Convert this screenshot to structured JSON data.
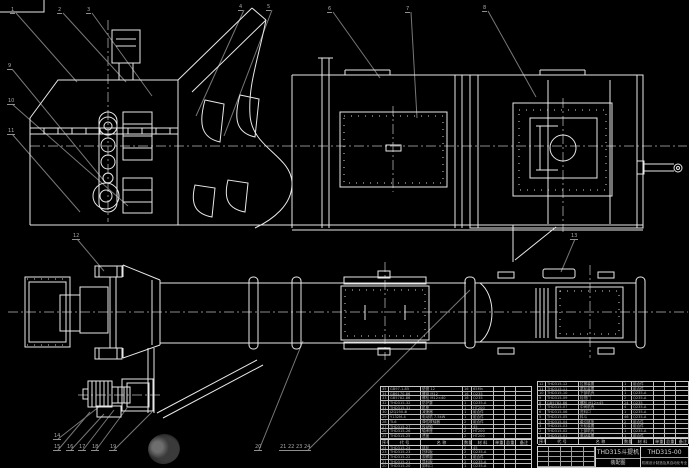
{
  "drawing": {
    "number": "THD315-00",
    "title": "THD315斗提机",
    "subtitle": "装配图",
    "org": "机械设计制造及其自动化专业"
  },
  "colors": {
    "background": "#000000",
    "line": "#e8e8e8",
    "centerline": "#8a8a8a",
    "leader": "#777777",
    "callout": "#a8a8a8",
    "table_line": "#c9c9c9",
    "table_text": "#b5b5b5",
    "title_text": "#d8d8d8"
  },
  "callouts": [
    {
      "label": "1",
      "x": 10,
      "y": 8
    },
    {
      "label": "2",
      "x": 57,
      "y": 8
    },
    {
      "label": "3",
      "x": 86,
      "y": 8
    },
    {
      "label": "4",
      "x": 238,
      "y": 5
    },
    {
      "label": "5",
      "x": 266,
      "y": 5
    },
    {
      "label": "6",
      "x": 327,
      "y": 7
    },
    {
      "label": "7",
      "x": 405,
      "y": 7
    },
    {
      "label": "8",
      "x": 482,
      "y": 6
    },
    {
      "label": "9",
      "x": 7,
      "y": 64
    },
    {
      "label": "10",
      "x": 7,
      "y": 99
    },
    {
      "label": "11",
      "x": 7,
      "y": 129
    },
    {
      "label": "12",
      "x": 72,
      "y": 234
    },
    {
      "label": "13",
      "x": 570,
      "y": 234
    },
    {
      "label": "14",
      "x": 53,
      "y": 434
    },
    {
      "label": "15",
      "x": 53,
      "y": 445
    },
    {
      "label": "16",
      "x": 66,
      "y": 445
    },
    {
      "label": "17",
      "x": 78,
      "y": 445
    },
    {
      "label": "18",
      "x": 91,
      "y": 445
    },
    {
      "label": "19",
      "x": 109,
      "y": 445
    },
    {
      "label": "20",
      "x": 254,
      "y": 445
    },
    {
      "label": "21",
      "x": 279,
      "y": 445
    },
    {
      "label": "22",
      "x": 287,
      "y": 445
    },
    {
      "label": "23",
      "x": 295,
      "y": 445
    },
    {
      "label": "24",
      "x": 303,
      "y": 445
    }
  ],
  "bom_right": {
    "headers": [
      "序号",
      "代  号",
      "名  称",
      "数量",
      "材  料",
      "单重",
      "总重",
      "备注"
    ],
    "col_widths": [
      8,
      33,
      44,
      9,
      22,
      11,
      11,
      14
    ],
    "rows": [
      [
        "12",
        "THD315-12",
        "拉紧装置",
        "1",
        "组合件",
        "",
        "",
        ""
      ],
      [
        "11",
        "THD315-11",
        "尾轮装置",
        "1",
        "组合件",
        "",
        "",
        ""
      ],
      [
        "10",
        "THD315-10",
        "下部机壳",
        "1",
        "Q235-A",
        "",
        "",
        ""
      ],
      [
        "9",
        "THD315-09",
        "检视门",
        "2",
        "Q235-A",
        "",
        "",
        ""
      ],
      [
        "8",
        "GB5782-86",
        "螺栓 M12×45",
        "24",
        "Q235",
        "",
        "",
        ""
      ],
      [
        "7",
        "THD315-07",
        "中间机壳",
        "4",
        "Q235-A",
        "",
        "",
        ""
      ],
      [
        "6",
        "THD315-06",
        "进料口",
        "1",
        "Q235-A",
        "",
        "",
        ""
      ],
      [
        "5",
        "THD315-05",
        "料斗",
        "46",
        "Q235-A",
        "",
        "",
        ""
      ],
      [
        "4",
        "THD315-04",
        "牵引链条",
        "2",
        "组合件",
        "",
        "",
        ""
      ],
      [
        "3",
        "THD315-03",
        "头轮装置",
        "1",
        "组合件",
        "",
        "",
        ""
      ],
      [
        "2",
        "THD315-02",
        "上部机壳",
        "1",
        "Q235-A",
        "",
        "",
        ""
      ],
      [
        "1",
        "THD315-01",
        "驱动装置",
        "1",
        "组合件",
        "",
        "",
        ""
      ]
    ]
  },
  "bom_left": {
    "headers": [
      "序号",
      "代  号",
      "名  称",
      "数量",
      "材  料",
      "单重",
      "总重",
      "备注"
    ],
    "col_widths": [
      8,
      32,
      42,
      9,
      22,
      11,
      11,
      16
    ],
    "upper_rows": [
      [
        "35",
        "GB97.1-85",
        "垫圈 12",
        "16",
        "65Mn",
        "",
        "",
        ""
      ],
      [
        "34",
        "GB6170-86",
        "螺母 M12",
        "16",
        "Q235",
        "",
        "",
        ""
      ],
      [
        "33",
        "GB5782-86",
        "螺栓 M12×40",
        "16",
        "Q235",
        "",
        "",
        ""
      ],
      [
        "32",
        "THD315-32",
        "防护罩",
        "1",
        "Q235-A",
        "",
        "",
        ""
      ],
      [
        "31",
        "THD315-31",
        "机座",
        "1",
        "HT200",
        "",
        "",
        ""
      ],
      [
        "30",
        "JZQ250-Ⅲ",
        "减速器",
        "1",
        "组合件",
        "",
        "",
        ""
      ],
      [
        "29",
        "Y132M-4",
        "电动机 7.5kW",
        "1",
        "组合件",
        "",
        "",
        ""
      ],
      [
        "28",
        "TL6",
        "弹性联轴器",
        "2",
        "组合件",
        "",
        "",
        ""
      ],
      [
        "27",
        "THD315-27",
        "传动轴",
        "1",
        "45",
        "",
        "",
        ""
      ],
      [
        "26",
        "THD315-26",
        "轴承座",
        "2",
        "HT200",
        "",
        "",
        ""
      ],
      [
        "25",
        "THD315-25",
        "透盖",
        "2",
        "HT200",
        "",
        "",
        ""
      ]
    ],
    "lower_rows": [
      [
        "24",
        "THD315-24",
        "链轮",
        "2",
        "45",
        "",
        "",
        ""
      ],
      [
        "23",
        "THD315-23",
        "挡料板",
        "2",
        "Q235-A",
        "",
        "",
        ""
      ],
      [
        "22",
        "THD315-22",
        "观察窗",
        "1",
        "组合件",
        "",
        "",
        ""
      ],
      [
        "21",
        "THD315-21",
        "导料板",
        "2",
        "Q235-A",
        "",
        "",
        ""
      ],
      [
        "20",
        "THD315-20",
        "卸料口",
        "1",
        "Q235-A",
        "",
        "",
        ""
      ]
    ]
  },
  "revision_table": {
    "rows": 4,
    "cols": 5
  }
}
